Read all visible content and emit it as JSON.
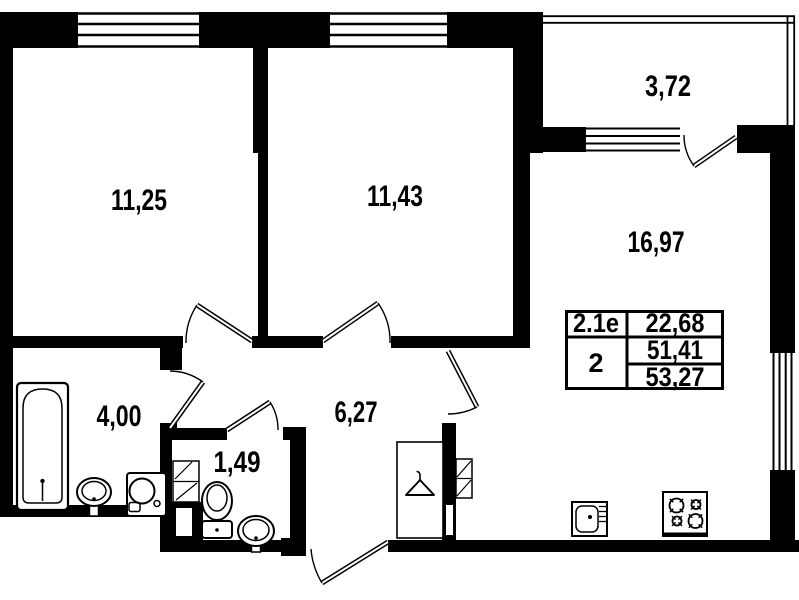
{
  "title": "Apartment floor plan 2-room",
  "colors": {
    "wall": "#000000",
    "background": "#ffffff"
  },
  "plan": {
    "rooms": [
      {
        "name": "bedroom-1",
        "area": "11,25"
      },
      {
        "name": "bedroom-2",
        "area": "11,43"
      },
      {
        "name": "balcony",
        "area": "3,72"
      },
      {
        "name": "kitchen-living-room",
        "area": "16,97"
      },
      {
        "name": "bathroom",
        "area": "4,00"
      },
      {
        "name": "wc",
        "area": "1,49"
      },
      {
        "name": "hallway",
        "area": "6,27"
      }
    ]
  },
  "info_table": {
    "unit_type": "2.1е",
    "living_area": "22,68",
    "room_count": "2",
    "area_without_balcony": "51,41",
    "total_area": "53,27"
  },
  "fixtures": [
    "bathtub",
    "washbasin",
    "washing-machine",
    "toilet",
    "kitchen-sink",
    "stove",
    "wardrobe",
    "ventilation-shaft"
  ]
}
